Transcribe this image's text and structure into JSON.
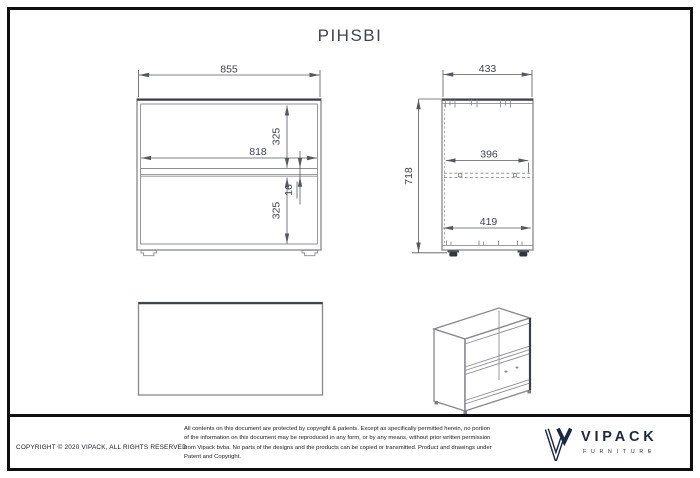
{
  "title": "PIHSBI",
  "dims": {
    "front_width": "855",
    "front_top_height": "325",
    "front_inner_width": "818",
    "front_shelf_thickness": "16",
    "front_bottom_height": "325",
    "side_width": "433",
    "side_height": "718",
    "side_shelf_depth": "396",
    "side_inner_depth": "419"
  },
  "footer": {
    "copyright": "COPYRIGHT © 2020 VIPACK, ALL RIGHTS RESERVED",
    "disclaimer": "All contents on this document are protected by copyright & patents. Except as specifically permitted herein, no portion of the information on this document may be reproduced in any form, or by any means, without prior written permission from Vipack bvba. No parts of the designs and the products can be copied or transmitted. Product and drawings under Patent and Copyright.",
    "brand": {
      "name": "VIPACK",
      "tagline": "FURNITURE"
    }
  },
  "colors": {
    "frame": "#0e0e0e",
    "drawing_line": "#85888c",
    "dimension_text": "#3d424d",
    "brand_navy": "#1c2742"
  }
}
